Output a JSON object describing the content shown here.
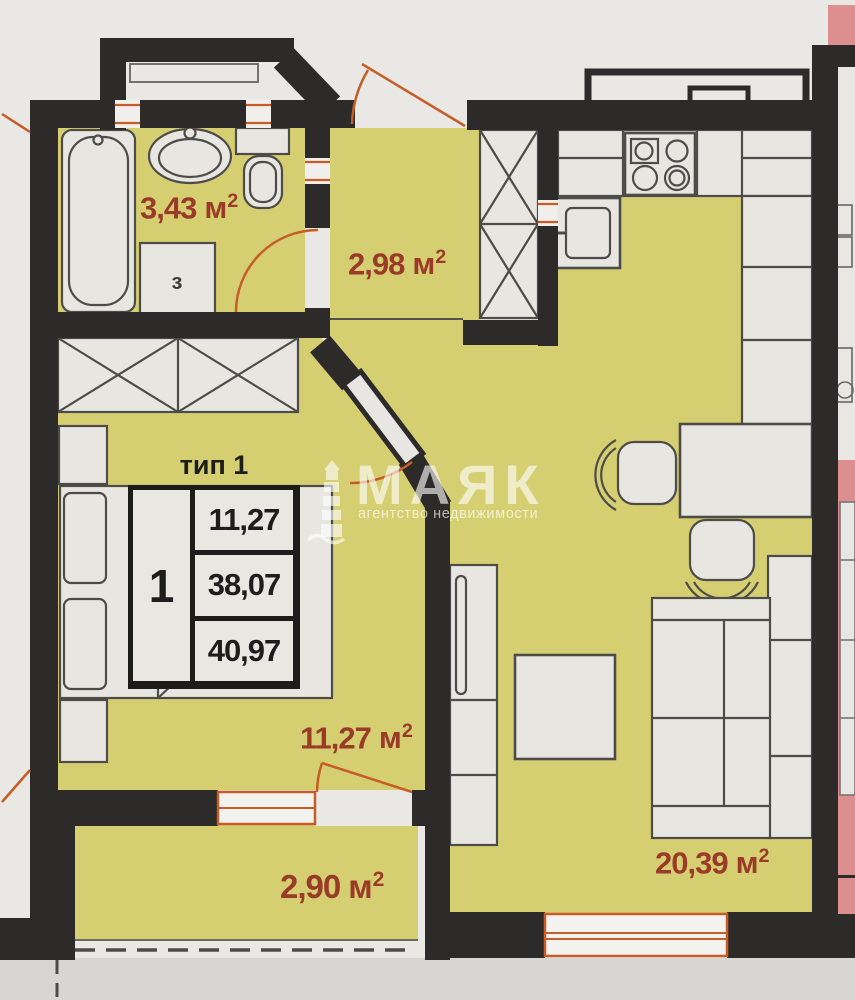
{
  "stamp": {
    "type_label": "тип 1",
    "rooms_count": "1",
    "living_area": "11,27",
    "apartment_area": "38,07",
    "total_area": "40,97"
  },
  "room_labels": {
    "bathroom": {
      "value": "3,43",
      "unit": "м",
      "sup": "2"
    },
    "hall": {
      "value": "2,98",
      "unit": "м",
      "sup": "2"
    },
    "bedroom": {
      "value": "11,27",
      "unit": "м",
      "sup": "2"
    },
    "balcony": {
      "value": "2,90",
      "unit": "м",
      "sup": "2"
    },
    "living_room": {
      "value": "20,39",
      "unit": "м",
      "sup": "2"
    }
  },
  "fixtures": {
    "washing_machine_label": "з"
  },
  "watermark": {
    "brand": "МАЯК",
    "tagline": "агентство недвижимости",
    "icon": "lighthouse-icon"
  },
  "colors": {
    "paper": "#eae8e4",
    "floor": "#d6cf72",
    "wall": "#2d2b29",
    "accent_orange": "#c65c28",
    "adjacent_apartment": "#dd8e8e",
    "area_label": "#9a3a28",
    "furniture_fill": "#e8e6e1",
    "furniture_stroke": "#4d4c49"
  }
}
